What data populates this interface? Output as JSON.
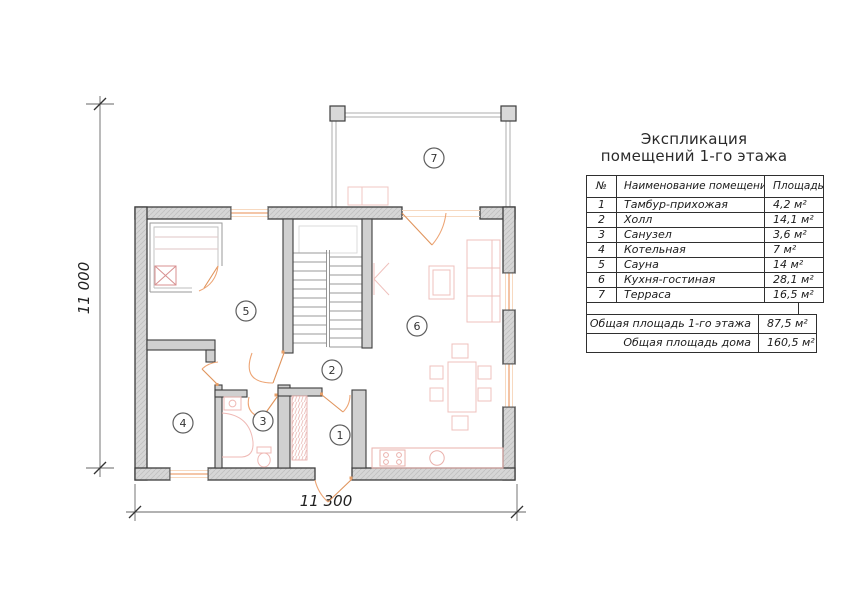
{
  "header": {
    "title_line1": "Экспликация",
    "title_line2": "помещений 1-го этажа"
  },
  "table": {
    "headers": {
      "num": "№",
      "name": "Наименование помещения",
      "area": "Площадь"
    },
    "rows": [
      {
        "num": "1",
        "name": "Тамбур-прихожая",
        "area": "4,2 м²"
      },
      {
        "num": "2",
        "name": "Холл",
        "area": "14,1 м²"
      },
      {
        "num": "3",
        "name": "Санузел",
        "area": "3,6 м²"
      },
      {
        "num": "4",
        "name": "Котельная",
        "area": "7 м²"
      },
      {
        "num": "5",
        "name": "Сауна",
        "area": "14 м²"
      },
      {
        "num": "6",
        "name": "Кухня-гостиная",
        "area": "28,1 м²"
      },
      {
        "num": "7",
        "name": "Терраса",
        "area": "16,5 м²"
      }
    ],
    "totals": [
      {
        "label": "Общая площадь 1-го этажа",
        "value": "87,5 м²"
      },
      {
        "label": "Общая площадь дома",
        "value": "160,5 м²"
      }
    ]
  },
  "plan": {
    "dim_width": "11 300",
    "dim_height": "11 000"
  },
  "colors": {
    "wall_outline": "#3d3d3d",
    "wall_fill": "#d6d6d6",
    "opening_accent": "#eda575",
    "furniture_accent": "#efc0bc"
  }
}
